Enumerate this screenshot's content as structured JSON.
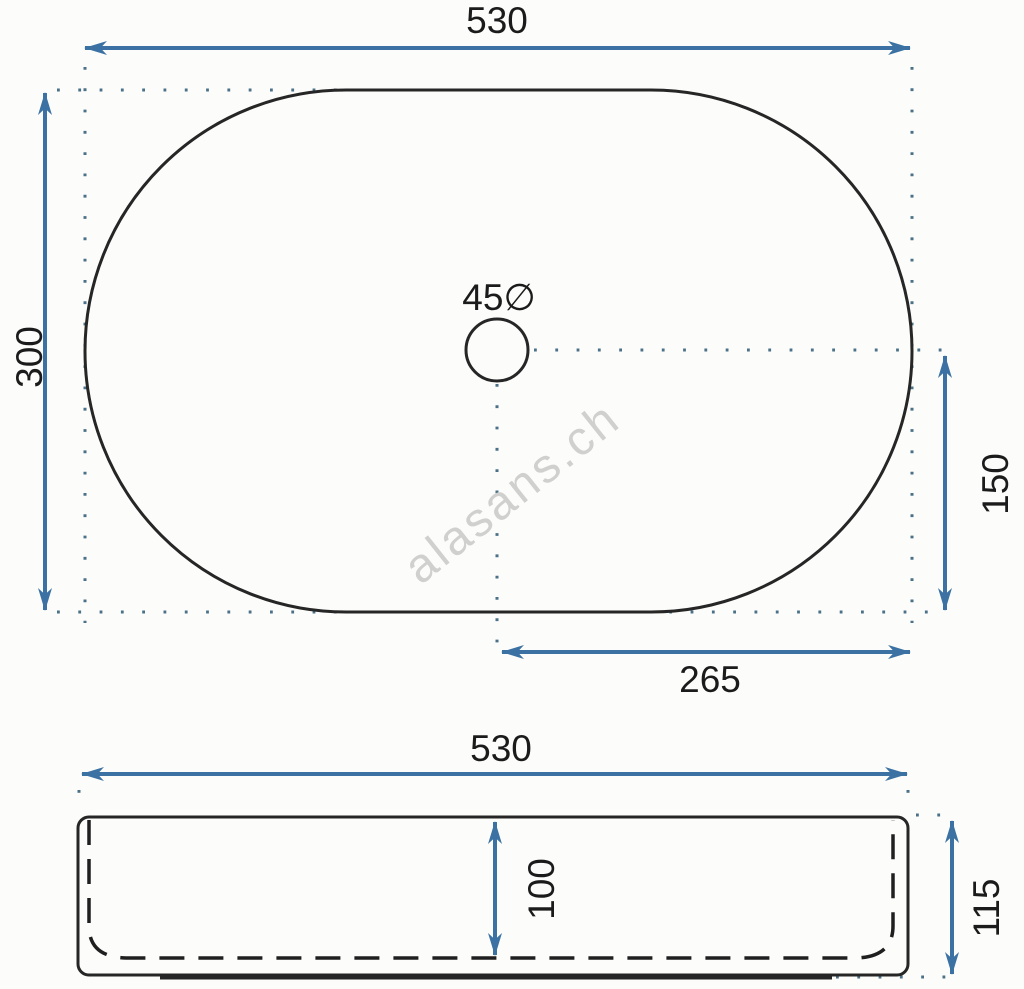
{
  "colors": {
    "background": "#fcfcfa",
    "outline": "#262626",
    "dimension_blue": "#3b72a3",
    "reference_dots": "#4a7187",
    "label_text": "#1b1b1b",
    "watermark": "#d0d0ce"
  },
  "watermark": {
    "text": "alasans.ch"
  },
  "top_view": {
    "overall_width": "530",
    "overall_depth": "300",
    "drain_diameter": "45∅",
    "drain_offset_horizontal": "265",
    "drain_offset_vertical": "150"
  },
  "side_view": {
    "overall_width": "530",
    "inner_depth": "100",
    "overall_height": "115"
  }
}
